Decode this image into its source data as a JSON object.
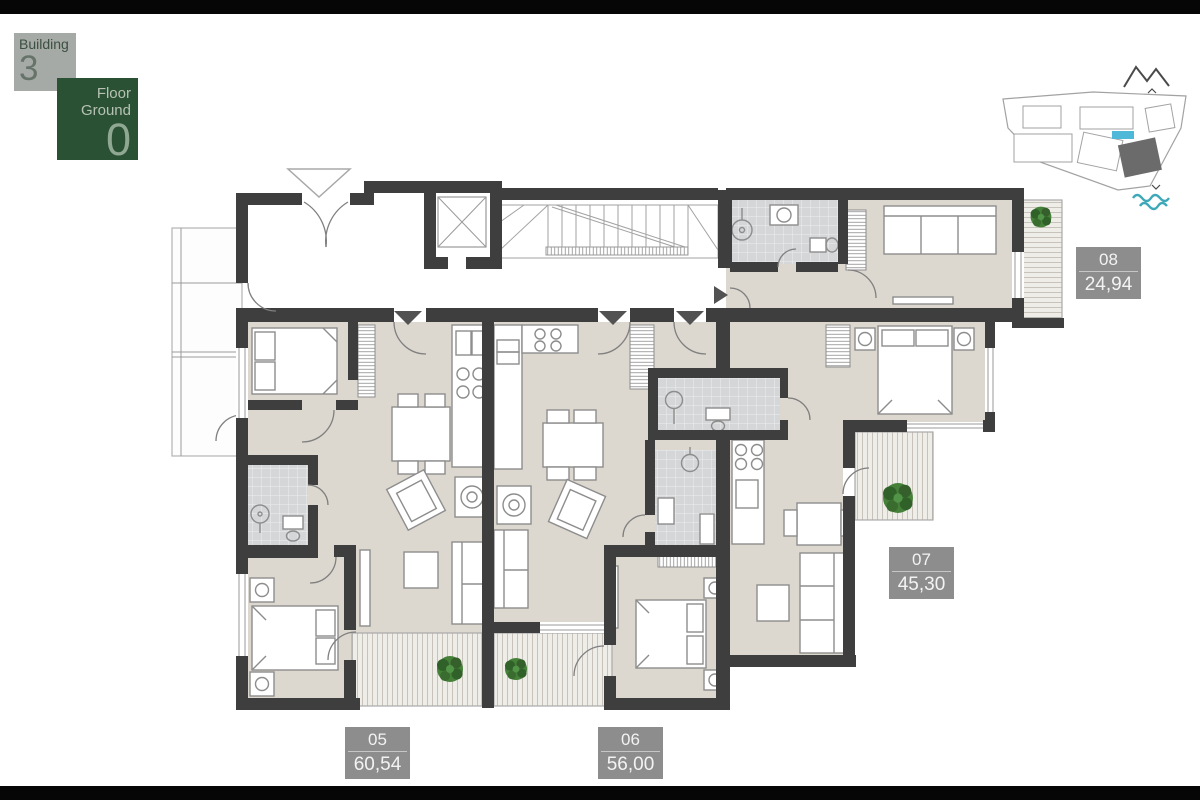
{
  "building_badge": {
    "label": "Building",
    "number": "3"
  },
  "floor_badge": {
    "label": "Floor",
    "name": "Ground",
    "number": "0"
  },
  "apartments": [
    {
      "number": "08",
      "area": "24,94"
    },
    {
      "number": "07",
      "area": "45,30"
    },
    {
      "number": "05",
      "area": "60,54"
    },
    {
      "number": "06",
      "area": "56,00"
    }
  ],
  "site_map": {
    "selected_building_color": "#6b6b6b",
    "pool_color": "#4db8d8",
    "waves_color": "#3fa8b8",
    "mountains_color": "#4a4a4a"
  },
  "plan_colors": {
    "wall": "#3e3e3e",
    "room_floor": "#ddd8cf",
    "tile_floor": "#d4d6d8",
    "plant_green": "#46813a",
    "area_badge_bg": "#8d8d8d",
    "floor_badge_bg": "#2b5134",
    "building_badge_bg": "#a6aaa6"
  }
}
